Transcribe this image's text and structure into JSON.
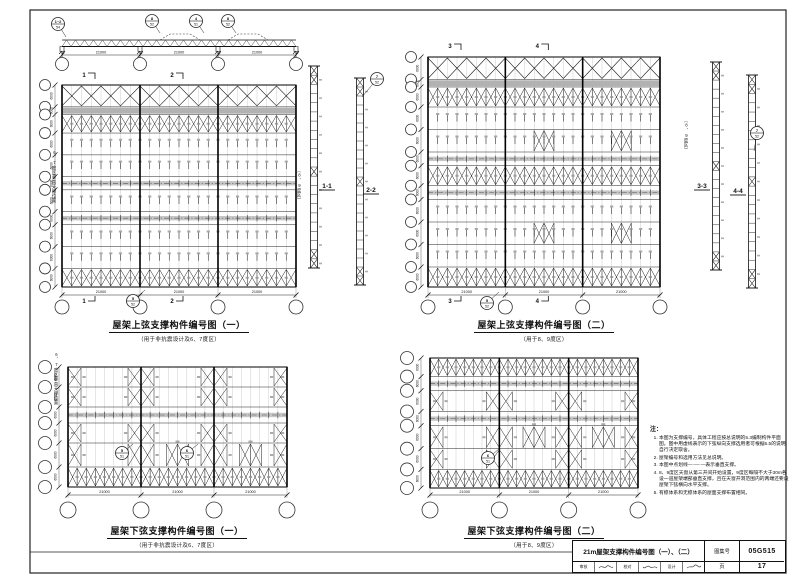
{
  "elevation": {
    "span_dims": [
      "21000",
      "21000",
      "21000"
    ],
    "detail_bubbles": [
      {
        "num": "1~2",
        "sheet": "54"
      },
      {
        "num": "8",
        "sheet": "52"
      },
      {
        "num": "4",
        "sheet": "51"
      },
      {
        "num": "8",
        "sheet": "52"
      }
    ]
  },
  "plans": [
    {
      "title": "屋架上弦支撑构件编号图（一）",
      "subtitle": "（用于非抗震设计及6、7度区）",
      "bay_dims": [
        "21000",
        "21000",
        "21000"
      ],
      "row_dim": "6000",
      "section_marks": [
        "1",
        "2"
      ],
      "detail_bubble": {
        "num": "5",
        "sheet": "52"
      }
    },
    {
      "title": "屋架上弦支撑构件编号图（二）",
      "subtitle": "（用于8、9度区）",
      "bay_dims": [
        "21000",
        "21000",
        "21000"
      ],
      "row_dim": "6000",
      "section_marks": [
        "3",
        "4"
      ],
      "detail_bubble": {
        "num": "5",
        "sheet": "52"
      }
    },
    {
      "title": "屋架下弦支撑构件编号图（一）",
      "subtitle": "（用于非抗震设计及6、7度区）",
      "bay_dims": [
        "21000",
        "21000",
        "21000"
      ],
      "row_dim": "6000",
      "detail_bubbles": [
        {
          "num": "5",
          "sheet": "51"
        },
        {
          "num": "6",
          "sheet": "51"
        }
      ]
    },
    {
      "title": "屋架下弦支撑构件编号图（二）",
      "subtitle": "（用于8、9度区）",
      "bay_dims": [
        "21000",
        "21000",
        "21000"
      ],
      "row_dim": "6000",
      "detail_bubbles": [
        {
          "num": "6",
          "sheet": "51"
        }
      ]
    }
  ],
  "sections": [
    {
      "label": "1-1"
    },
    {
      "label": "2-2",
      "bubble": {
        "num": "7",
        "sheet": "52"
      }
    },
    {
      "label": "3-3"
    },
    {
      "label": "4-4",
      "bubble": {
        "num": "7",
        "sheet": "52"
      }
    }
  ],
  "side_labels": {
    "zone67": "6、7度区垂直支撑位置",
    "zone89": "（8、9度区）"
  },
  "notes": {
    "heading": "注：",
    "items": [
      "本图为支撑编号，具体工程应按总说明的5.3编制构件平面图。图中用虚线表示的下弦纵向支撑选用者可根据5.5的说明自行决定取舍。",
      "屋架编号和选用方法见总说明。",
      "本图中点划线—·—·—表示垂直支撑。",
      "8、9度区天窗从第三开间开始设置，9度区每隔不大于30m各设一道屋架端部垂直支撑，且在天窗开洞范围内的两端还要设屋架下弦横向水平支撑。",
      "有檩体系和无檩体系的屋面支撑布置相同。"
    ]
  },
  "title_block": {
    "title": "21m屋架支撑构件编号图（一）、（二）",
    "atlas_label": "图集号",
    "atlas_no": "05G515",
    "page_label": "页",
    "page_no": "17",
    "roles": [
      "审核",
      "校对",
      "设计"
    ]
  },
  "colors": {
    "line": "#1a1a1a",
    "shade": "#c6c6c6",
    "dark_band": "#b2b2b2",
    "smudge": "#8d8d8d"
  }
}
